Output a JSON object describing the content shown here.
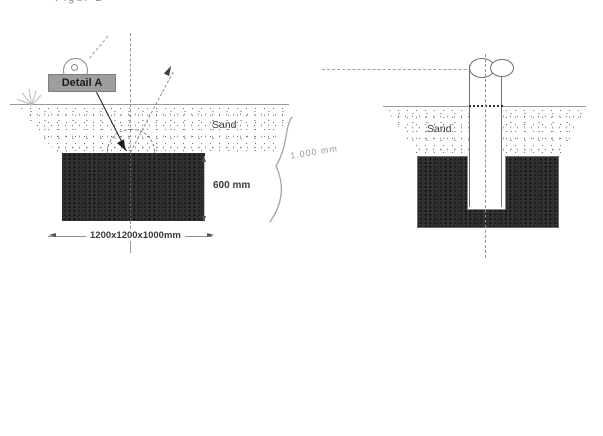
{
  "page": {
    "caption": "Figur B"
  },
  "left": {
    "detail_label": "Detail A",
    "sand_label": "Sand",
    "depth_dim_label": "600 mm",
    "footing_dim_label": "1200x1200x1000mm",
    "handwritten_depth_label": "1.000 mm"
  },
  "right": {
    "sand_label": "Sand"
  },
  "colors": {
    "block_fill": "#2b2b2b",
    "label_bg": "#9e9e9e",
    "pencil": "#9a9a9a",
    "ink": "#3a3a3a"
  }
}
